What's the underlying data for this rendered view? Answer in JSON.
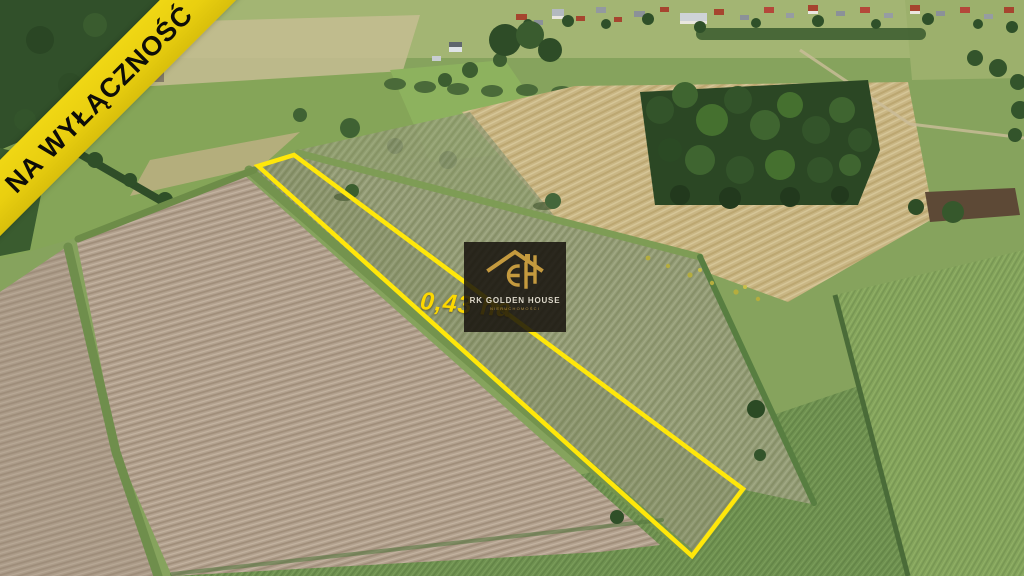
{
  "meta": {
    "type": "real-estate-listing-photo",
    "view": "aerial-drone-summer-farmland"
  },
  "overlay": {
    "ribbon": {
      "label": "NA WYŁĄCZNOŚĆ",
      "background": "#ecd40e",
      "text_color": "#0e0d08"
    },
    "area_label": {
      "text": "0,43 ha",
      "color": "#fcd800"
    },
    "plot_outline": {
      "color": "#ffe70a",
      "shape": "long-narrow-quadrilateral"
    },
    "watermark": {
      "brand": "RK GOLDEN HOUSE",
      "subtitle": "NIERUCHOMOŚCI",
      "icon": "gold-house-gh-monogram-icon",
      "gold": "#c49a3e",
      "background": "rgba(22,18,13,0.85)"
    }
  },
  "scene": {
    "description": "Plowed tan field lower-left, narrow fallow strip outlined in yellow running to lower-right, birch grove and harvested stubble upper-right, village houses on the horizon, green meadows bottom and right",
    "palette": {
      "plowed_field": "#b2a18e",
      "fallow_strip": "#959d78",
      "meadow": "#6f9150",
      "stubble": "#c9b684",
      "forest": "#31502a",
      "base_green": "#86a35d"
    }
  }
}
